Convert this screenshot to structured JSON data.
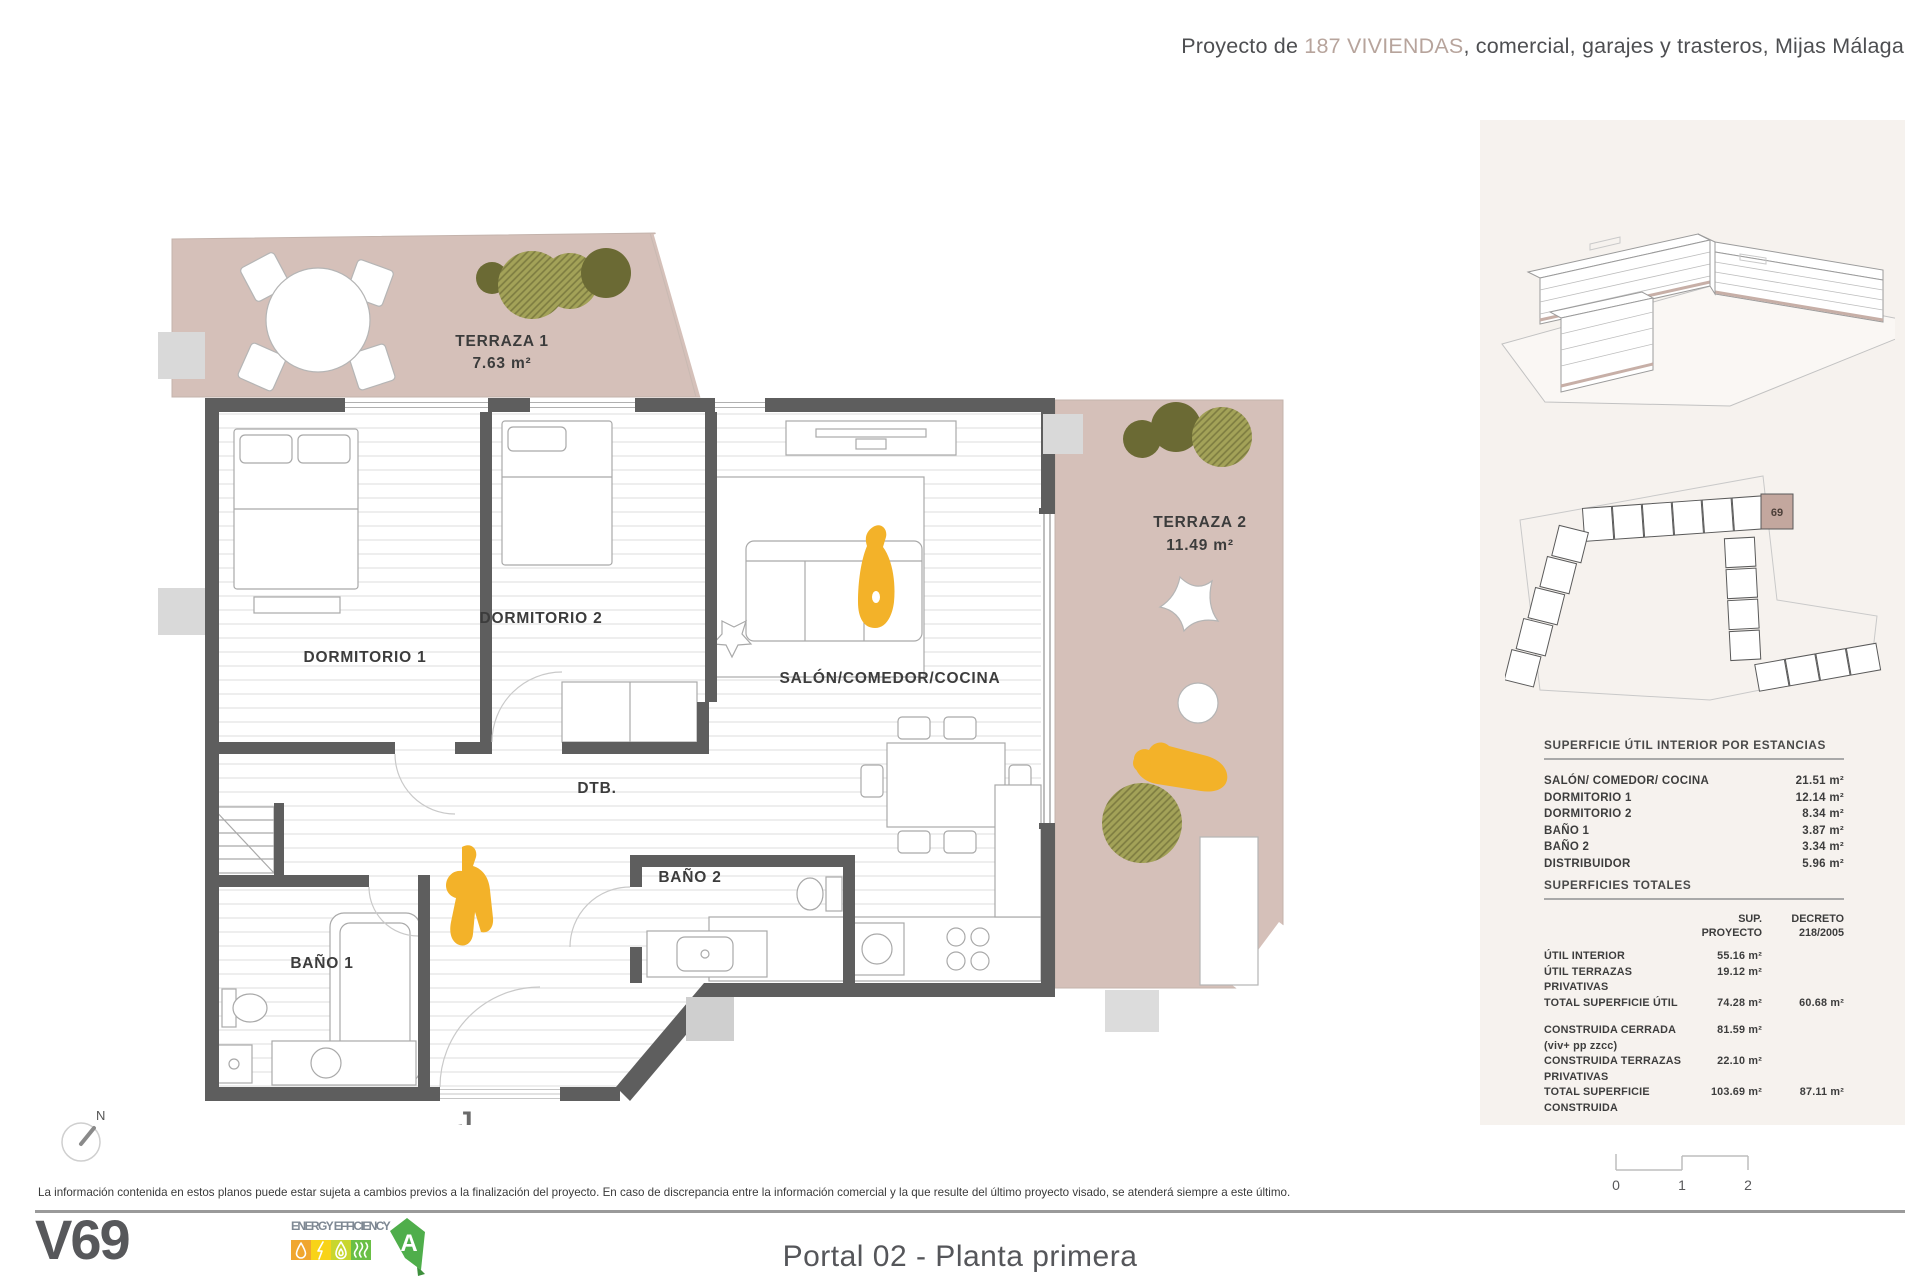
{
  "header": {
    "prefix": "Proyecto de ",
    "highlight": "187 VIVIENDAS",
    "suffix": ", comercial, garajes y trasteros, Mijas Málaga"
  },
  "plan": {
    "terrace1_name": "TERRAZA 1",
    "terrace1_area": "7.63 m²",
    "terrace2_name": "TERRAZA 2",
    "terrace2_area": "11.49 m²",
    "room_dormitorio1": "DORMITORIO 1",
    "room_dormitorio2": "DORMITORIO 2",
    "room_salon": "SALÓN/COMEDOR/COCINA",
    "room_dtb": "DTB.",
    "room_bano1": "BAÑO 1",
    "room_bano2": "BAÑO 2",
    "entrance_marker": "J",
    "compass": "N"
  },
  "sidebar": {
    "keyplan_unit": "69",
    "interior_table": {
      "title": "SUPERFICIE ÚTIL INTERIOR POR ESTANCIAS",
      "rows": [
        {
          "label": "SALÓN/ COMEDOR/ COCINA",
          "value": "21.51 m²"
        },
        {
          "label": "DORMITORIO 1",
          "value": "12.14 m²"
        },
        {
          "label": "DORMITORIO 2",
          "value": "8.34 m²"
        },
        {
          "label": "BAÑO 1",
          "value": "3.87 m²"
        },
        {
          "label": "BAÑO 2",
          "value": "3.34 m²"
        },
        {
          "label": "DISTRIBUIDOR",
          "value": "5.96 m²"
        }
      ]
    },
    "totals_table": {
      "title": "SUPERFICIES TOTALES",
      "col1_header_line1": "SUP.",
      "col1_header_line2": "PROYECTO",
      "col2_header_line1": "DECRETO",
      "col2_header_line2": "218/2005",
      "rows": [
        {
          "label": "ÚTIL INTERIOR",
          "proyecto": "55.16 m²",
          "decreto": ""
        },
        {
          "label": "ÚTIL TERRAZAS PRIVATIVAS",
          "proyecto": "19.12 m²",
          "decreto": ""
        },
        {
          "label": "TOTAL SUPERFICIE ÚTIL",
          "proyecto": "74.28 m²",
          "decreto": "60.68 m²"
        },
        {
          "label": "CONSTRUIDA CERRADA (viv+ pp zzcc)",
          "proyecto": "81.59 m²",
          "decreto": ""
        },
        {
          "label": "CONSTRUIDA TERRAZAS PRIVATIVAS",
          "proyecto": "22.10 m²",
          "decreto": ""
        },
        {
          "label": "TOTAL SUPERFICIE CONSTRUIDA",
          "proyecto": "103.69 m²",
          "decreto": "87.11 m²"
        }
      ]
    }
  },
  "footer": {
    "disclaimer": "La información contenida en estos planos puede estar sujeta a cambios previos a la finalización del proyecto. En caso de discrepancia entre la información comercial y la que resulte del último proyecto visado, se atenderá siempre a este último.",
    "unit_code": "V69",
    "energy_label": "ENERGY EFFICIENCY",
    "energy_rating": "A",
    "plan_title": "Portal 02 - Planta primera"
  },
  "scalebar": {
    "t0": "0",
    "t1": "1",
    "t2": "2"
  },
  "colors": {
    "terrace": "#d5c0b9",
    "wall": "#5e5e5e",
    "accent-text": "#b7a49c",
    "figure": "#f3b229",
    "tree-dark": "#6b6a34",
    "tree-light": "#a3a258",
    "sidebar-bg": "#f6f2ee",
    "keyplan-unit": "#c3a79e",
    "energy-1": "#f0a62f",
    "energy-2": "#f8d318",
    "energy-3": "#c8d62e",
    "energy-4": "#6abf45",
    "energy-arrow": "#4fae4b"
  }
}
